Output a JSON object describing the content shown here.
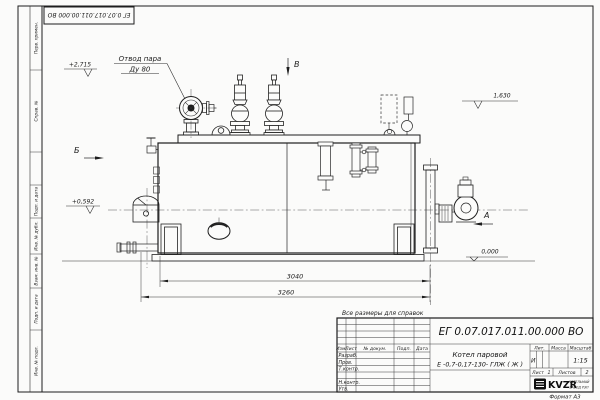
{
  "frame": {
    "left_stamps": [
      "Перв. примен.",
      "Справ. №",
      "Подп. и дата",
      "Инв. № дубл.",
      "Взам. инв. №",
      "Подп. и дата",
      "Инв. № подл."
    ],
    "top_flipped_number": "ЕГ 0.07.017.011.00.000 ВО",
    "format_note": "Формат А3"
  },
  "drawing": {
    "reference_note": "Все размеры для справок",
    "callout_steam_line1": "Отвод пара",
    "callout_steam_line2": "Ду 80",
    "view_labels": {
      "a": "А",
      "b": "Б",
      "v": "В"
    },
    "elevations": {
      "platform": "+2,715",
      "burner": "+0,592",
      "right": "1,630",
      "ground": "0,000"
    },
    "dimensions": {
      "body_length": "3040",
      "overall_length": "3260"
    }
  },
  "title_block": {
    "doc_number": "ЕГ 0.07.017.011.00.000  ВО",
    "product_line1": "Котел паровой",
    "product_line2": "Е -0,7-0,17-130- ГЛЖ ( Ж )",
    "col_izm": "Изм.",
    "col_list": "Лист",
    "col_ndoc": "№ докум.",
    "col_podp": "Подп.",
    "col_data": "Дата",
    "row_razrab": "Разраб.",
    "row_prov": "Пров.",
    "row_tkontr": "Т.контр.",
    "row_nkontr": "Н.контр.",
    "row_utv": "Утв.",
    "lit_header": "Лит.",
    "mass_header": "Масса",
    "scale_header": "Масштаб",
    "lit_value": "И",
    "scale_value": "1:15",
    "sheet_label": "Лист",
    "sheet_number": "1",
    "sheets_label": "Листов",
    "sheets_total": "2",
    "logo_text": "KVZR",
    "company_line1": "КОТЕЛЬНЫЙ",
    "company_line2": "ЗАВОД РЭП"
  }
}
